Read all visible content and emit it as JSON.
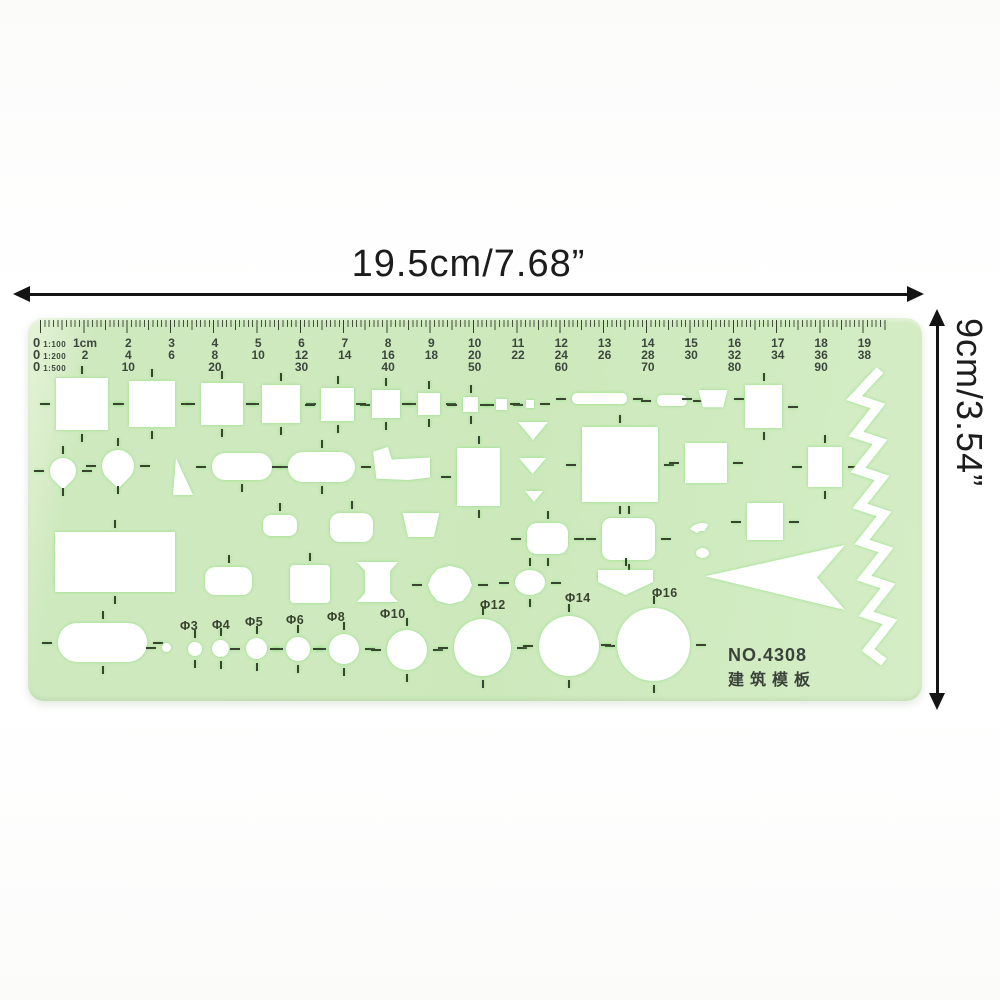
{
  "colors": {
    "green-body": "#cfe9bf",
    "cutout": "#ffffff",
    "ink": "#141414",
    "print": "#3c463c"
  },
  "dimensions": {
    "width_label": "19.5cm/7.68”",
    "height_label": "9cm/3.54”"
  },
  "template": {
    "model_number": "NO.4308",
    "model_name": "建筑模板",
    "ruler": {
      "zeros": [
        {
          "zero": "0",
          "scale": "1:100"
        },
        {
          "zero": "0",
          "scale": "1:200"
        },
        {
          "zero": "0",
          "scale": "1:500"
        }
      ],
      "columns": [
        [
          "1cm",
          "2",
          ""
        ],
        [
          "2",
          "4",
          "10"
        ],
        [
          "3",
          "6",
          ""
        ],
        [
          "4",
          "8",
          "20"
        ],
        [
          "5",
          "10",
          ""
        ],
        [
          "6",
          "12",
          "30"
        ],
        [
          "7",
          "14",
          ""
        ],
        [
          "8",
          "16",
          "40"
        ],
        [
          "9",
          "18",
          ""
        ],
        [
          "10",
          "20",
          "50"
        ],
        [
          "11",
          "22",
          ""
        ],
        [
          "12",
          "24",
          "60"
        ],
        [
          "13",
          "26",
          ""
        ],
        [
          "14",
          "28",
          "70"
        ],
        [
          "15",
          "30",
          ""
        ],
        [
          "16",
          "32",
          "80"
        ],
        [
          "17",
          "34",
          ""
        ],
        [
          "18",
          "36",
          "90"
        ],
        [
          "19",
          "38",
          ""
        ]
      ]
    },
    "circle_labels": [
      {
        "text": "Φ3",
        "x": 152,
        "y": 301
      },
      {
        "text": "Φ4",
        "x": 184,
        "y": 300
      },
      {
        "text": "Φ5",
        "x": 217,
        "y": 297
      },
      {
        "text": "Φ6",
        "x": 258,
        "y": 295
      },
      {
        "text": "Φ8",
        "x": 299,
        "y": 292
      },
      {
        "text": "Φ10",
        "x": 352,
        "y": 289
      },
      {
        "text": "Φ12",
        "x": 452,
        "y": 280
      },
      {
        "text": "Φ14",
        "x": 537,
        "y": 273
      },
      {
        "text": "Φ16",
        "x": 624,
        "y": 268
      }
    ],
    "shapes": [
      {
        "t": "sq",
        "x": 28,
        "y": 60,
        "w": 52,
        "h": 52,
        "k": "tblr"
      },
      {
        "t": "sq",
        "x": 101,
        "y": 63,
        "w": 46,
        "h": 46,
        "k": "tblr"
      },
      {
        "t": "sq",
        "x": 173,
        "y": 65,
        "w": 42,
        "h": 42,
        "k": "tblr"
      },
      {
        "t": "sq",
        "x": 234,
        "y": 67,
        "w": 38,
        "h": 38,
        "k": "tblr"
      },
      {
        "t": "sq",
        "x": 293,
        "y": 70,
        "w": 33,
        "h": 33,
        "k": "tblr"
      },
      {
        "t": "sq",
        "x": 344,
        "y": 72,
        "w": 28,
        "h": 28,
        "k": "tblr"
      },
      {
        "t": "sq",
        "x": 390,
        "y": 75,
        "w": 22,
        "h": 22,
        "k": "tblr"
      },
      {
        "t": "sq",
        "x": 435,
        "y": 79,
        "w": 15,
        "h": 15,
        "k": "tblr"
      },
      {
        "t": "sq",
        "x": 468,
        "y": 81,
        "w": 11,
        "h": 11,
        "k": "lr"
      },
      {
        "t": "sq",
        "x": 498,
        "y": 82,
        "w": 8,
        "h": 8,
        "k": "lr"
      },
      {
        "t": "slot",
        "x": 544,
        "y": 75,
        "w": 55,
        "h": 11,
        "r": 5,
        "k": "lr"
      },
      {
        "t": "slot",
        "x": 629,
        "y": 77,
        "w": 30,
        "h": 11,
        "r": 5,
        "k": "lr"
      },
      {
        "t": "trap",
        "x": 670,
        "y": 72,
        "w": 30,
        "h": 18,
        "k": "lr"
      },
      {
        "t": "sq",
        "x": 717,
        "y": 67,
        "w": 37,
        "h": 43,
        "k": "tbr"
      },
      {
        "t": "drop",
        "x": 22,
        "y": 140,
        "w": 26,
        "h": 26,
        "k": "tblr"
      },
      {
        "t": "drop",
        "x": 74,
        "y": 132,
        "w": 32,
        "h": 32,
        "k": "tblr"
      },
      {
        "t": "trir",
        "x": 145,
        "y": 140,
        "w": 20,
        "h": 37
      },
      {
        "t": "slot",
        "x": 184,
        "y": 135,
        "w": 60,
        "h": 27,
        "r": 13,
        "k": "lrb"
      },
      {
        "t": "slot",
        "x": 260,
        "y": 134,
        "w": 67,
        "h": 30,
        "r": 15,
        "k": "tlrb"
      },
      {
        "t": "boot",
        "x": 345,
        "y": 129,
        "w": 57,
        "h": 33
      },
      {
        "t": "sq",
        "x": 429,
        "y": 130,
        "w": 43,
        "h": 58,
        "k": "tbl"
      },
      {
        "t": "tri",
        "x": 490,
        "y": 104,
        "w": 30,
        "h": 18
      },
      {
        "t": "tri",
        "x": 491,
        "y": 140,
        "w": 27,
        "h": 16
      },
      {
        "t": "tri",
        "x": 497,
        "y": 173,
        "w": 18,
        "h": 11
      },
      {
        "t": "sq",
        "x": 554,
        "y": 109,
        "w": 76,
        "h": 75,
        "k": "tblr"
      },
      {
        "t": "sq",
        "x": 657,
        "y": 125,
        "w": 42,
        "h": 40,
        "k": "lr"
      },
      {
        "t": "sq",
        "x": 780,
        "y": 129,
        "w": 34,
        "h": 40,
        "k": "tblr"
      },
      {
        "t": "sq",
        "x": 27,
        "y": 214,
        "w": 120,
        "h": 60,
        "k": "tb"
      },
      {
        "t": "slot",
        "x": 235,
        "y": 197,
        "w": 34,
        "h": 21,
        "r": 8,
        "k": "t"
      },
      {
        "t": "slot",
        "x": 302,
        "y": 195,
        "w": 43,
        "h": 29,
        "r": 10,
        "k": "t"
      },
      {
        "t": "trap",
        "x": 374,
        "y": 195,
        "w": 38,
        "h": 25
      },
      {
        "t": "slot",
        "x": 499,
        "y": 205,
        "w": 41,
        "h": 31,
        "r": 10,
        "k": "tblr"
      },
      {
        "t": "slot",
        "x": 574,
        "y": 200,
        "w": 53,
        "h": 42,
        "r": 9,
        "k": "tblr"
      },
      {
        "t": "arc",
        "x": 660,
        "y": 205,
        "w": 26,
        "h": 22
      },
      {
        "t": "circle",
        "x": 668,
        "y": 230,
        "w": 13,
        "h": 10
      },
      {
        "t": "sq",
        "x": 719,
        "y": 185,
        "w": 36,
        "h": 37,
        "k": "lr"
      },
      {
        "t": "slot",
        "x": 177,
        "y": 249,
        "w": 47,
        "h": 28,
        "r": 10,
        "k": "t"
      },
      {
        "t": "sq",
        "x": 262,
        "y": 247,
        "w": 40,
        "h": 38,
        "r": 4,
        "k": "t"
      },
      {
        "t": "spool",
        "x": 327,
        "y": 244,
        "w": 45,
        "h": 40
      },
      {
        "t": "lens",
        "x": 400,
        "y": 247,
        "w": 44,
        "h": 40,
        "k": "lr"
      },
      {
        "t": "circle",
        "x": 487,
        "y": 252,
        "w": 30,
        "h": 25,
        "k": "tblr"
      },
      {
        "t": "shield",
        "x": 570,
        "y": 252,
        "w": 55,
        "h": 25,
        "k": "t"
      },
      {
        "t": "arrowl",
        "x": 677,
        "y": 227,
        "w": 140,
        "h": 65
      },
      {
        "t": "slot",
        "x": 30,
        "y": 305,
        "w": 89,
        "h": 39,
        "r": 19,
        "k": "tblr"
      },
      {
        "t": "circle",
        "x": 134,
        "y": 325,
        "w": 9,
        "h": 9,
        "k": "l"
      },
      {
        "t": "circle",
        "x": 160,
        "y": 324,
        "w": 14,
        "h": 14,
        "k": "tb"
      },
      {
        "t": "circle",
        "x": 184,
        "y": 322,
        "w": 17,
        "h": 17,
        "k": "tb"
      },
      {
        "t": "circle",
        "x": 218,
        "y": 320,
        "w": 21,
        "h": 21,
        "k": "tblr"
      },
      {
        "t": "circle",
        "x": 258,
        "y": 319,
        "w": 24,
        "h": 24,
        "k": "tblr"
      },
      {
        "t": "circle",
        "x": 301,
        "y": 316,
        "w": 30,
        "h": 30,
        "k": "tblr"
      },
      {
        "t": "circle",
        "x": 359,
        "y": 312,
        "w": 40,
        "h": 40,
        "k": "tblr"
      },
      {
        "t": "circle",
        "x": 426,
        "y": 301,
        "w": 57,
        "h": 57,
        "k": "tblr"
      },
      {
        "t": "circle",
        "x": 511,
        "y": 298,
        "w": 60,
        "h": 60,
        "k": "tblr"
      },
      {
        "t": "circle",
        "x": 589,
        "y": 290,
        "w": 73,
        "h": 73,
        "k": "tblr"
      }
    ]
  }
}
